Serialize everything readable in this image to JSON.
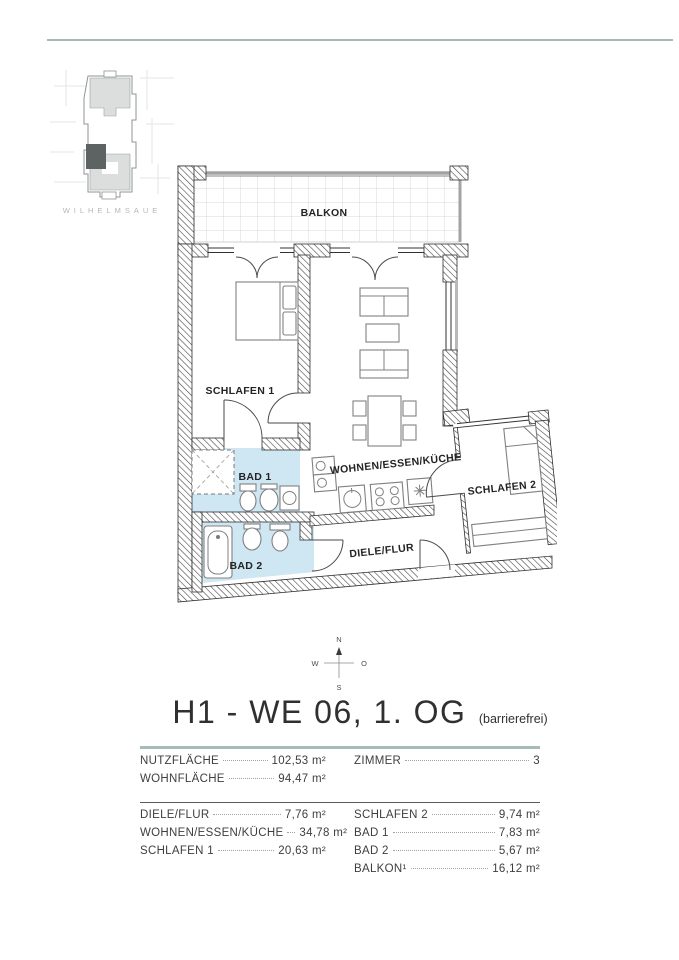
{
  "page": {
    "location_label": "WILHELMSAUE"
  },
  "floor_plan": {
    "rooms": {
      "balkon": "BALKON",
      "schlafen1": "SCHLAFEN 1",
      "bad1": "BAD 1",
      "bad2": "BAD 2",
      "wohnen": "WOHNEN/ESSEN/KÜCHE",
      "diele": "DIELE/FLUR",
      "schlafen2": "SCHLAFEN 2"
    },
    "bath_color": "#cfe7f2"
  },
  "compass": {
    "north": "N",
    "east": "O",
    "south": "S",
    "west": "W"
  },
  "title": {
    "main": "H1 - WE 06, 1. OG",
    "suffix": "(barrierefrei)"
  },
  "summary": {
    "left": [
      {
        "label": "NUTZFLÄCHE",
        "value": "102,53 m²"
      },
      {
        "label": "WOHNFLÄCHE",
        "value": "94,47 m²"
      }
    ],
    "right": [
      {
        "label": "ZIMMER",
        "value": "3"
      }
    ]
  },
  "room_table": {
    "left": [
      {
        "label": "DIELE/FLUR",
        "value": "7,76 m²"
      },
      {
        "label": "WOHNEN/ESSEN/KÜCHE",
        "value": "34,78 m²"
      },
      {
        "label": "SCHLAFEN 1",
        "value": "20,63 m²"
      }
    ],
    "right": [
      {
        "label": "SCHLAFEN 2",
        "value": "9,74 m²"
      },
      {
        "label": "BAD 1",
        "value": "7,83 m²"
      },
      {
        "label": "BAD 2",
        "value": "5,67 m²"
      },
      {
        "label": "BALKON¹",
        "value": "16,12 m²"
      }
    ]
  },
  "colors": {
    "accent_rule": "#a6bab7",
    "dark_rule": "#565e5c"
  }
}
